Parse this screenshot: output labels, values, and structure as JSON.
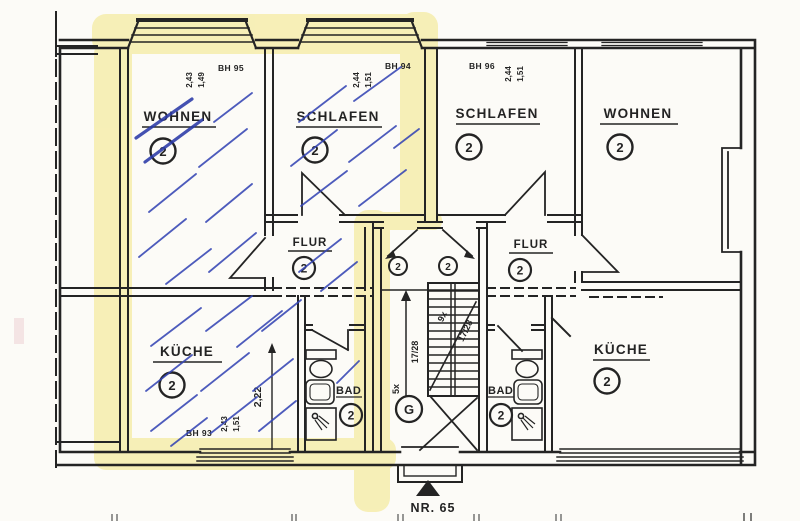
{
  "colors": {
    "ink": "#242424",
    "highlighter": "#f1e478",
    "pen_blue": "#3545b4",
    "pen_blue_bold": "#2b3aa8",
    "paper": "#fcfbf7"
  },
  "rooms": {
    "left": {
      "wohnen": {
        "label": "WOHNEN",
        "occupancy": "2"
      },
      "schlafen": {
        "label": "SCHLAFEN",
        "occupancy": "2"
      },
      "flur": {
        "label": "FLUR",
        "occupancy": "2"
      },
      "kueche": {
        "label": "KÜCHE",
        "occupancy": "2"
      },
      "bad": {
        "label": "BAD",
        "occupancy": "2"
      }
    },
    "right": {
      "schlafen": {
        "label": "SCHLAFEN",
        "occupancy": "2"
      },
      "wohnen": {
        "label": "WOHNEN",
        "occupancy": "2"
      },
      "flur": {
        "label": "FLUR",
        "occupancy": "2"
      },
      "bad": {
        "label": "BAD",
        "occupancy": "2"
      },
      "kueche": {
        "label": "KÜCHE",
        "occupancy": "2"
      }
    }
  },
  "windows": {
    "bh95": {
      "code": "BH 95",
      "dim1": "2,43",
      "dim2": "1,49"
    },
    "bh94": {
      "code": "BH 94",
      "dim1": "2,44",
      "dim2": "1,51"
    },
    "bh96": {
      "code": "BH 96",
      "dim1": "2,44",
      "dim2": "1,51"
    },
    "bh93": {
      "code": "BH 93",
      "dim1": "2,43",
      "dim2": "1,51"
    }
  },
  "dimensions": {
    "kueche_left_width": "2,22"
  },
  "stairwell": {
    "ground_floor": "G",
    "door_left_occupancy": "2",
    "door_right_occupancy": "2",
    "flight_lower_count": "5x",
    "flight_lower_tread": "17/28",
    "flight_upper_count": "9x",
    "flight_upper_tread": "17/28"
  },
  "entrance": {
    "house_number": "NR. 65"
  }
}
